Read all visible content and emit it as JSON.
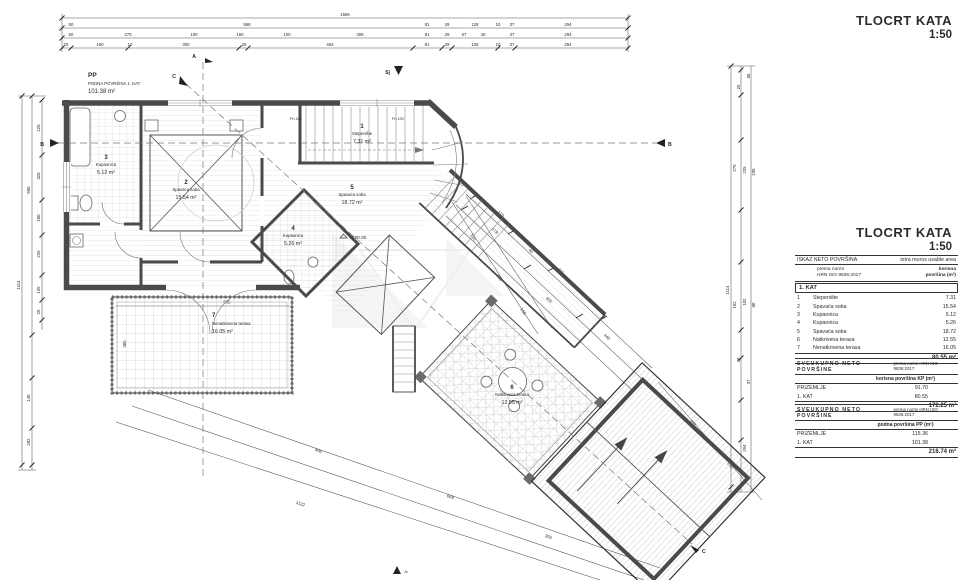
{
  "titles": {
    "main": "TLOCRT KATA",
    "scale": "1:50"
  },
  "plan": {
    "pp": {
      "code": "PP",
      "sub": "PODNA POVRŠINA 1. KAT",
      "area": "101.38 m²"
    },
    "elevation": "+290.00",
    "pn1": "Pn 100",
    "pn2": "Pn 100",
    "rooms": [
      {
        "num": "1",
        "name": "Stepenište",
        "area": "7.31 m²"
      },
      {
        "num": "2",
        "name": "Spavaća soba",
        "area": "15.54 m²"
      },
      {
        "num": "3",
        "name": "Kupaonica",
        "area": "5.12 m²"
      },
      {
        "num": "4",
        "name": "Kupaonica",
        "area": "5.26 m²"
      },
      {
        "num": "5",
        "name": "Spavaća soba",
        "area": "18.72 m²"
      },
      {
        "num": "6",
        "name": "Natkrivena terasa",
        "area": "12.55 m²"
      },
      {
        "num": "7",
        "name": "Nenatkrivena terasa",
        "area": "16.05 m²"
      }
    ],
    "markers": {
      "a": "A",
      "b": "B",
      "c": "C",
      "north": "Sj",
      "jz": "Jz"
    }
  },
  "dims": {
    "top1": [
      "1586"
    ],
    "top2": [
      "50",
      "958",
      "81",
      "29",
      "128",
      "10",
      "37",
      "294"
    ],
    "top3": [
      "50",
      "270",
      "100",
      "160",
      "100",
      "308",
      "81",
      "29",
      "67",
      "40",
      "37",
      "294"
    ],
    "top4": [
      "25",
      "160",
      "10",
      "300",
      "25",
      "463",
      "81",
      "29",
      "128",
      "10",
      "37",
      "294"
    ],
    "left": [
      "1114",
      "550",
      "225",
      "320",
      "100",
      "225",
      "139",
      "25",
      "140",
      "262"
    ],
    "right": [
      "50",
      "25",
      "275",
      "225",
      "235",
      "192",
      "102",
      "80",
      "38",
      "37",
      "294",
      "1114"
    ],
    "diag": [
      "170",
      "178",
      "411",
      "40",
      "405",
      "440"
    ],
    "low": [
      "406",
      "668",
      "1122",
      "355"
    ],
    "mid": [
      "100",
      "235",
      "150",
      "535",
      "385"
    ],
    "roof": [
      "355",
      "102"
    ]
  },
  "tables": {
    "neto": {
      "h1": "ISKAZ NETO POVRŠINA",
      "h2": "intra muros usable area",
      "s1a": "prema normi",
      "s1b": "HRN ISO 9836:2017",
      "s2a": "korisna",
      "s2b": "površina (m²)",
      "section": "1. KAT",
      "rows": [
        {
          "n": "1",
          "name": "Stepenište",
          "v": "7.31"
        },
        {
          "n": "2",
          "name": "Spavaća soba",
          "v": "15.54"
        },
        {
          "n": "3",
          "name": "Kupaonica",
          "v": "5.12"
        },
        {
          "n": "4",
          "name": "Kupaonica",
          "v": "5.26"
        },
        {
          "n": "5",
          "name": "Spavaća soba",
          "v": "18.72"
        },
        {
          "n": "6",
          "name": "Natkrivena terasa",
          "v": "12.55"
        },
        {
          "n": "7",
          "name": "Nenatkrivena terasa",
          "v": "16.05"
        }
      ],
      "total": "80.55 m²"
    },
    "kp": {
      "h1": "SVEUKUPNO NETO POVRŠINE",
      "h2": "prema normi HRN ISO 9836:2017",
      "col": "korisna površina KP (m²)",
      "rows": [
        {
          "name": "PRIZEMLJE",
          "v": "91.70"
        },
        {
          "name": "1. KAT",
          "v": "80.55"
        }
      ],
      "total": "172.25 m²"
    },
    "pp": {
      "h1": "SVEUKUPNO NETO POVRŠINE",
      "h2": "prema normi HRN ISO 9836:2017",
      "col": "podna površina PP (m²)",
      "rows": [
        {
          "name": "PRIZEMLJE",
          "v": "115.36"
        },
        {
          "name": "1. KAT",
          "v": "101.38"
        }
      ],
      "total": "216.74 m²"
    }
  }
}
